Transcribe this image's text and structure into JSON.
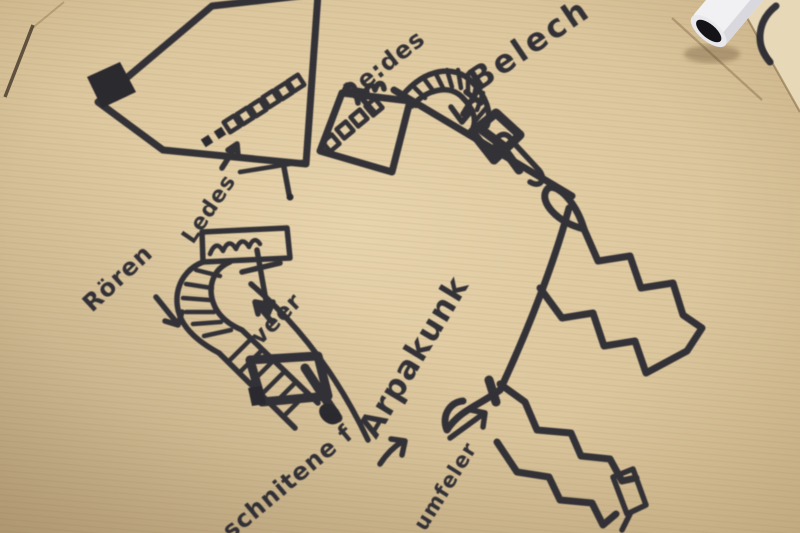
{
  "scene": {
    "description": "Photo of a hand-drawn black marker sketch on brown kraft paper",
    "paper_color": "#dcc69d",
    "ink_color": "#2c2a31",
    "objects": {
      "marker_pen": "white marker pen lying on top-right corner",
      "device_box_a": "large rectangle with black port and row of LED squares",
      "device_box_b": "small rectangle with LED squares and chimneys",
      "ribbed_hose": "striped hose arcing to diamond nozzle",
      "spring_box": "small box with wavy spring line",
      "curved_tube": "ribbed tube bending down to diamond foot",
      "zigzag_arrow_upper": "double zigzag lightning arrow to lower right",
      "zigzag_arrow_lower": "double zigzag lightning arrow at bottom"
    }
  },
  "labels": {
    "ledes_top": "Le:des",
    "belech": "Belech",
    "ledes_left": "Ledes",
    "roren": "Rören",
    "veer": "veer",
    "phrase_start": "schnitene f",
    "phrase_end": "Arpakunk",
    "umfeler": "umfeler"
  }
}
